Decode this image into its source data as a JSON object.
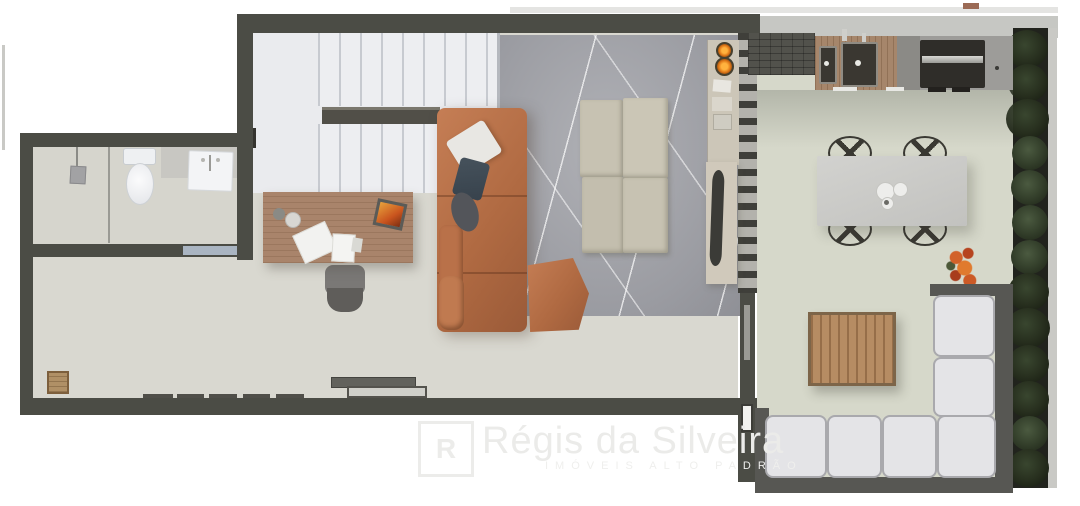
{
  "meta": {
    "kind": "architectural floor plan rendering, top view",
    "canvas": {
      "width": 1080,
      "height": 506
    }
  },
  "watermark": {
    "monogram": "R",
    "brand": "Régis da Silveira",
    "tagline": "IMÓVEIS ALTO PADRÃO"
  },
  "palette": {
    "wall": "#4b4c45",
    "indoor_floor": "#d9d8d0",
    "terrace_floor": "#d6d8ca",
    "rug": "#9a9ba1",
    "leather_sofa": "#b06a42",
    "desk_wood": "#a9846b",
    "outdoor_cushion": "#e4e4e7",
    "hedge_green": "#36422d",
    "burner_flame": "#e07818"
  },
  "rooms": {
    "bathroom": {
      "fixtures": [
        "shower",
        "toilet",
        "vanity-sink",
        "glass-door"
      ]
    },
    "living_office": {
      "furniture": [
        "staircase",
        "handrail",
        "desk",
        "office-chair",
        "leather-sofa",
        "leather-ottoman",
        "floor-cushion-grid",
        "area-rug",
        "cooktop-two-burners",
        "side-shelf",
        "slatted-divider",
        "sliding-door",
        "wood-stool",
        "floor-vents"
      ]
    },
    "gourmet_terrace": {
      "furniture": [
        "stone-counter",
        "wood-counter-double-sink",
        "grill",
        "dining-table-4-chairs",
        "plates",
        "flower-pot",
        "slatted-coffee-table",
        "l-shaped-outdoor-sofa",
        "hedge-planter"
      ]
    }
  }
}
